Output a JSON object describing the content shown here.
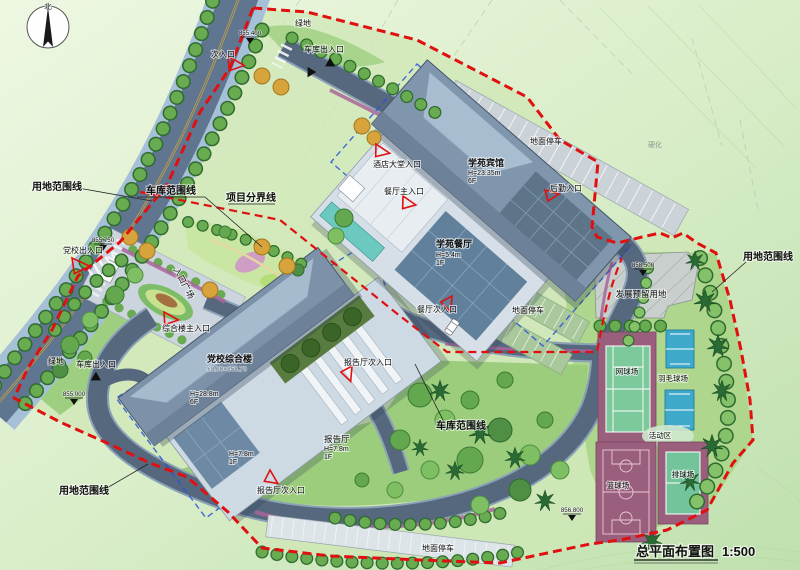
{
  "title": {
    "name": "总平面布置图",
    "scale": "1:500"
  },
  "compass": {
    "north": "北"
  },
  "boundary_labels": {
    "site": "用地范围线",
    "garage": "车库范围线",
    "project": "项目分界线"
  },
  "buildings": {
    "hotel": {
      "name": "学苑宾馆",
      "height": "H=23.35m",
      "floors": "6F"
    },
    "restaurant": {
      "name": "学苑餐厅",
      "height": "H=5.4m",
      "floors": "1F"
    },
    "academy": {
      "name": "党校综合楼",
      "level": "±0.00=858.70",
      "height": "H=28.8m",
      "floors": "6F"
    },
    "hall": {
      "name": "报告厅",
      "height": "H=7.8m",
      "floors": "1F"
    },
    "hall_wing": {
      "height": "H=7.8m",
      "floors": "1F"
    }
  },
  "entrances": {
    "secondary": "次入口",
    "party_school": "党校出入口",
    "garage": "车库出入口",
    "complex_main": "综合楼主入口",
    "hotel_lobby": "酒店大堂入口",
    "restaurant_main": "餐厅主入口",
    "restaurant_side": "餐厅次入口",
    "logistics": "后勤入口",
    "hall_side": "报告厅次入口"
  },
  "areas": {
    "green": "绿地",
    "plaza": "入口广场",
    "parking": "地面停车",
    "reserved": "发展预留用地",
    "tennis": "网球场",
    "badminton": "羽毛球场",
    "basketball": "篮球场",
    "volleyball": "排球场",
    "activity": "活动区",
    "hardened": "硬化"
  },
  "elevations": {
    "road_top": "855.400",
    "plaza": "855.750",
    "reserved": "858.500",
    "southeast": "856.800",
    "southwest": "855.000"
  },
  "colors": {
    "boundary_red": "#e01010",
    "garage_blue": "#2b50e0",
    "road": "#5f7590",
    "sidewalk": "#a6c1d7",
    "roof_blue": "#8096ad",
    "court_base": "#9b5f7e",
    "court_green": "#7cc99b",
    "court_blue": "#3fa9cc",
    "tree_green": "#63a84e"
  }
}
